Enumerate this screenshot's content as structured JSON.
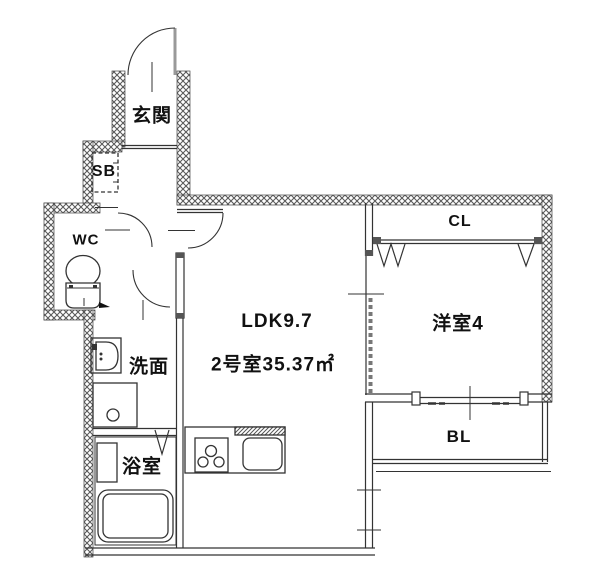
{
  "floorplan": {
    "labels": {
      "genkan": "玄関",
      "shoe_box": "SB",
      "wc": "WC",
      "washroom": "洗面",
      "bathroom": "浴室",
      "ldk": "LDK9.7",
      "unit": "2号室35.37㎡",
      "western_room": "洋室4",
      "closet": "CL",
      "balcony": "BL"
    },
    "colors": {
      "background": "#ffffff",
      "line": "#333333",
      "wall_hatch": "#5a5a5a",
      "text": "#111111"
    }
  }
}
